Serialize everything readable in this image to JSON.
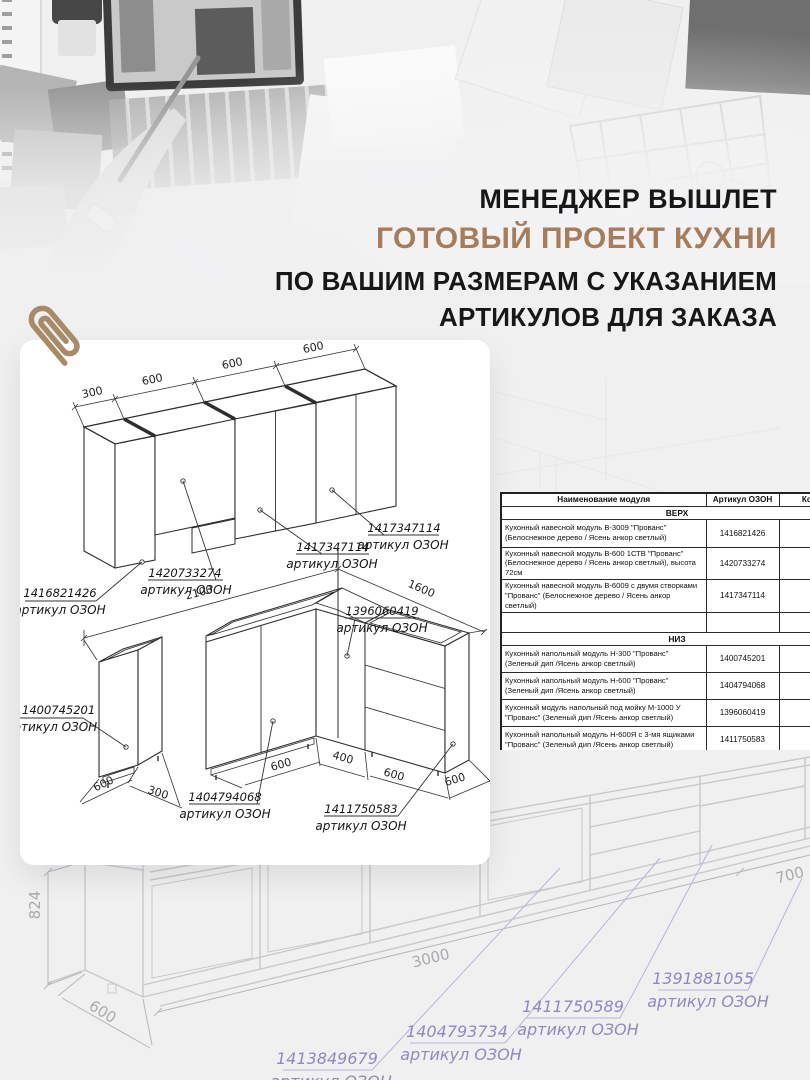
{
  "headline": {
    "line1": "МЕНЕДЖЕР ВЫШЛЕТ",
    "line2": "ГОТОВЫЙ ПРОЕКТ КУХНИ",
    "line3": "ПО ВАШИМ РАЗМЕРАМ С УКАЗАНИЕМ",
    "line4": "АРТИКУЛОВ ДЛЯ ЗАКАЗА"
  },
  "card": {
    "top": {
      "dims": [
        "300",
        "600",
        "600",
        "600"
      ],
      "labels": [
        {
          "article": "1416821426",
          "caption": "артикул ОЗОН"
        },
        {
          "article": "1420733274",
          "caption": "артикул ОЗОН"
        },
        {
          "article": "1417347114",
          "caption": "артикул ОЗОН"
        },
        {
          "article": "1417347114",
          "caption": "артикул ОЗОН"
        }
      ]
    },
    "bottom": {
      "dims": {
        "run_left": "2100",
        "run_right": "1600",
        "cab_depth": "600",
        "cab_width": "300",
        "d1": "600",
        "d2": "400",
        "d3": "600",
        "d4": "600"
      },
      "labels": [
        {
          "article": "1400745201",
          "caption": "артикул ОЗОН"
        },
        {
          "article": "1396060419",
          "caption": "артикул ОЗОН"
        },
        {
          "article": "1404794068",
          "caption": "артикул ОЗОН"
        },
        {
          "article": "1411750583",
          "caption": "артикул ОЗОН"
        }
      ]
    }
  },
  "table": {
    "headers": [
      "Наименование модуля",
      "Артикул ОЗОН",
      "Кол-во"
    ],
    "section_top": "ВЕРХ",
    "section_bottom": "НИЗ",
    "rows_top": [
      {
        "name": "Кухонный навесной модуль В-3009 \"Прованс\" (Белоснежное дерево / Ясень анкор светлый)",
        "article": "1416821426"
      },
      {
        "name": "Кухонный навесной модуль В-600 1СТВ \"Прованс\" (Белоснежное дерево / Ясень анкор светлый), высота 72см",
        "article": "1420733274"
      },
      {
        "name": "Кухонный навесной модуль В-6009 с двумя створками \"Прованс\" (Белоснежное дерево / Ясень анкор светлый)",
        "article": "1417347114"
      }
    ],
    "rows_bottom": [
      {
        "name": "Кухонный напольный модуль Н-300 \"Прованс\" (Зеленый дип /Ясень анкор светлый)",
        "article": "1400745201"
      },
      {
        "name": "Кухонный напольный модуль Н-600 \"Прованс\" (Зеленый дип /Ясень анкор светлый)",
        "article": "1404794068"
      },
      {
        "name": "Кухонный модуль напольный под мойку М-1000 У \"Прованс\" (Зеленый дип /Ясень анкор светлый)",
        "article": "1396060419"
      },
      {
        "name": "Кухонный напольный модуль Н-600Я с 3-мя ящиками \"Прованс\" (Зеленый дип /Ясень анкор светлый)",
        "article": "1411750583"
      }
    ]
  },
  "bg": {
    "dims": {
      "height": "824",
      "depth": "600",
      "run": "3000",
      "end": "700"
    },
    "labels": [
      {
        "article": "1413849679",
        "caption": "артикул ОЗОН"
      },
      {
        "article": "1404793734",
        "caption": "артикул ОЗОН"
      },
      {
        "article": "1411750589",
        "caption": "артикул ОЗОН"
      },
      {
        "article": "1391881055",
        "caption": "артикул ОЗОН"
      }
    ]
  }
}
